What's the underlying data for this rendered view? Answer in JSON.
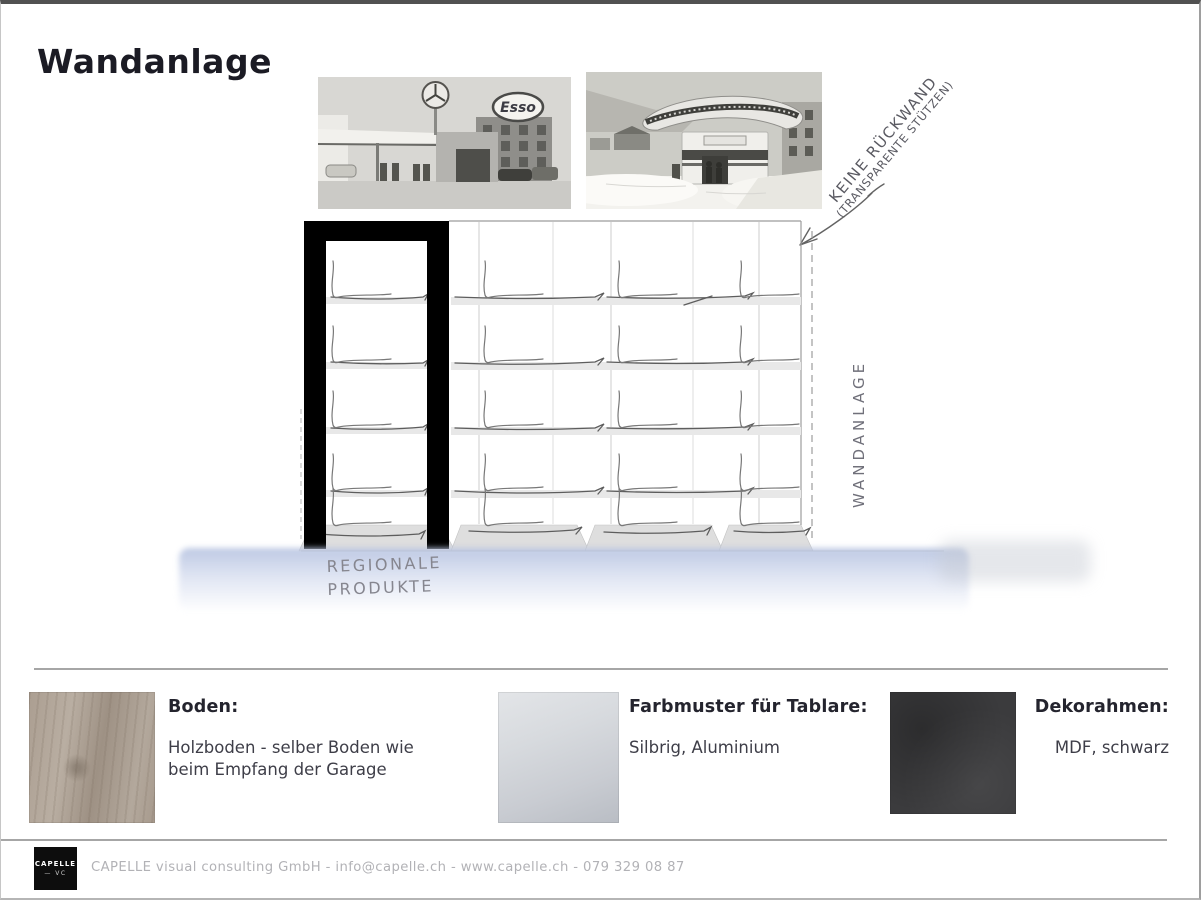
{
  "page": {
    "title": "Wandanlage"
  },
  "photos": {
    "garage": {
      "sign": "Esso"
    }
  },
  "sketch": {
    "annotation_line1": "KEINE RÜCKWAND",
    "annotation_line2": "(TRANSPARENTE STÜTZEN)",
    "side_label": "WANDANLAGE",
    "shelf_label_line1": "REGIONALE",
    "shelf_label_line2": "PRODUKTE"
  },
  "materials": [
    {
      "heading": "Boden:",
      "description": "Holzboden - selber Boden wie beim Empfang der Garage"
    },
    {
      "heading": "Farbmuster für Tablare:",
      "description": "Silbrig, Aluminium"
    },
    {
      "heading": "Dekorahmen:",
      "description": "MDF, schwarz"
    }
  ],
  "footer": {
    "logo_line1": "CAPELLE",
    "logo_line2": "— VC",
    "contact": "CAPELLE visual consulting GmbH - info@capelle.ch - www.capelle.ch - 079 329 08 87"
  },
  "colors": {
    "frame_black": "#000000",
    "shelf_gray": "#e8e8e8",
    "wash_blue": "#c9d3e8",
    "pencil": "#6f6f6f"
  }
}
